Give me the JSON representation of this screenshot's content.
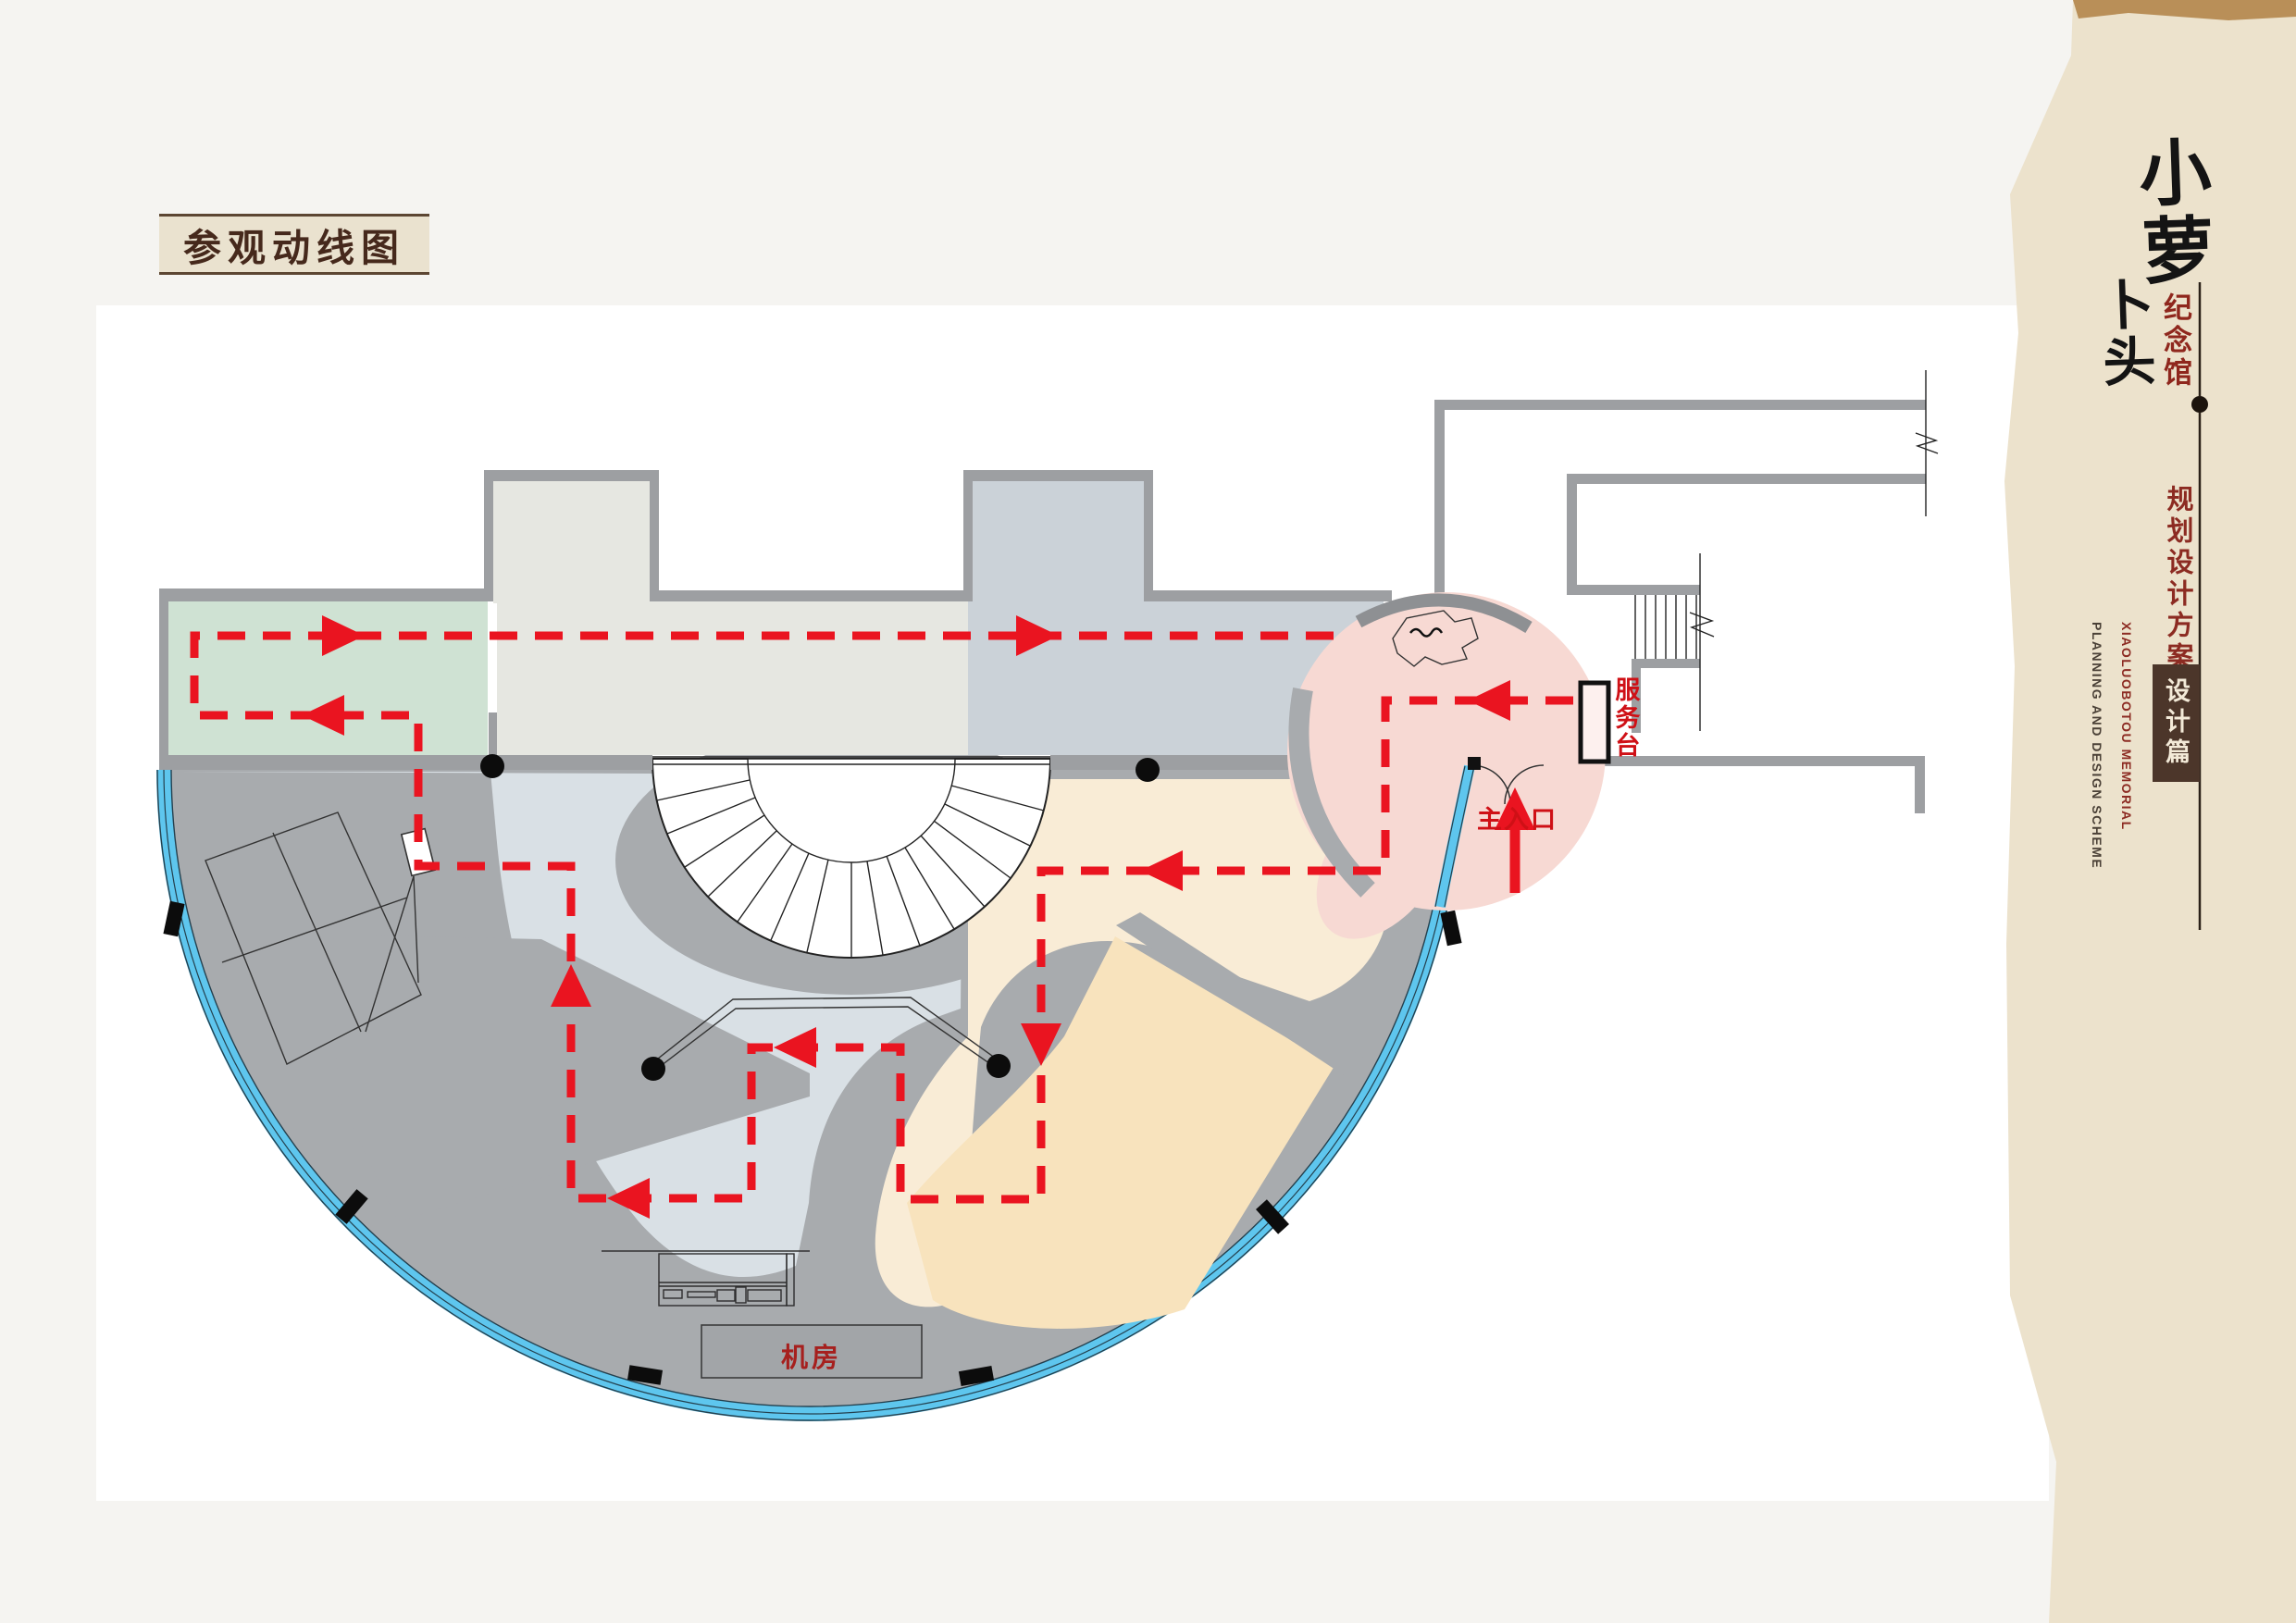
{
  "header": {
    "badge": "参观动线图"
  },
  "plan": {
    "labels": {
      "service_desk": "服务台",
      "main_entrance": "主入口",
      "machine_room": "机房"
    },
    "features": [
      "entrance-lobby",
      "service-desk",
      "main-entrance-door",
      "fan-staircase",
      "green-gallery",
      "main-hall",
      "west-exhibition-zone",
      "south-exhibition-zone",
      "machine-room",
      "curtain-wall-arc",
      "exterior-stair",
      "circulation-route"
    ],
    "route_arrow_count": 10,
    "column_dots": 4
  },
  "sidebar": {
    "title_top": "小萝",
    "title_bottom": "卜头",
    "hall_label": "纪念馆",
    "scheme_cn": "规划设计方案",
    "scheme_en_line1": "XIAOLUOBOTOU  MEMORIAL",
    "scheme_en_line2": "PLANNING AND DESIGN SCHEME",
    "chapter": "设计篇"
  },
  "colors": {
    "route_red": "#ea1420",
    "label_red": "#cf1016",
    "curtain_wall_blue": "#5ec6ee",
    "zone_green": "#cfe2d3",
    "zone_hall_gray": "#e6e7e1",
    "zone_blue_gray": "#d9e0e5",
    "zone_cream": "#f9ecd6",
    "zone_tan": "#f8e3bd",
    "zone_lobby_pink": "#f7d9d3",
    "wall_gray": "#9d9fa2",
    "poche_gray": "#a8abae",
    "sidebar_paper": "#ece2cc",
    "chapter_badge_brown": "#4c362a",
    "accent_dark_red": "#8c2b22",
    "title_brown": "#46291c"
  }
}
